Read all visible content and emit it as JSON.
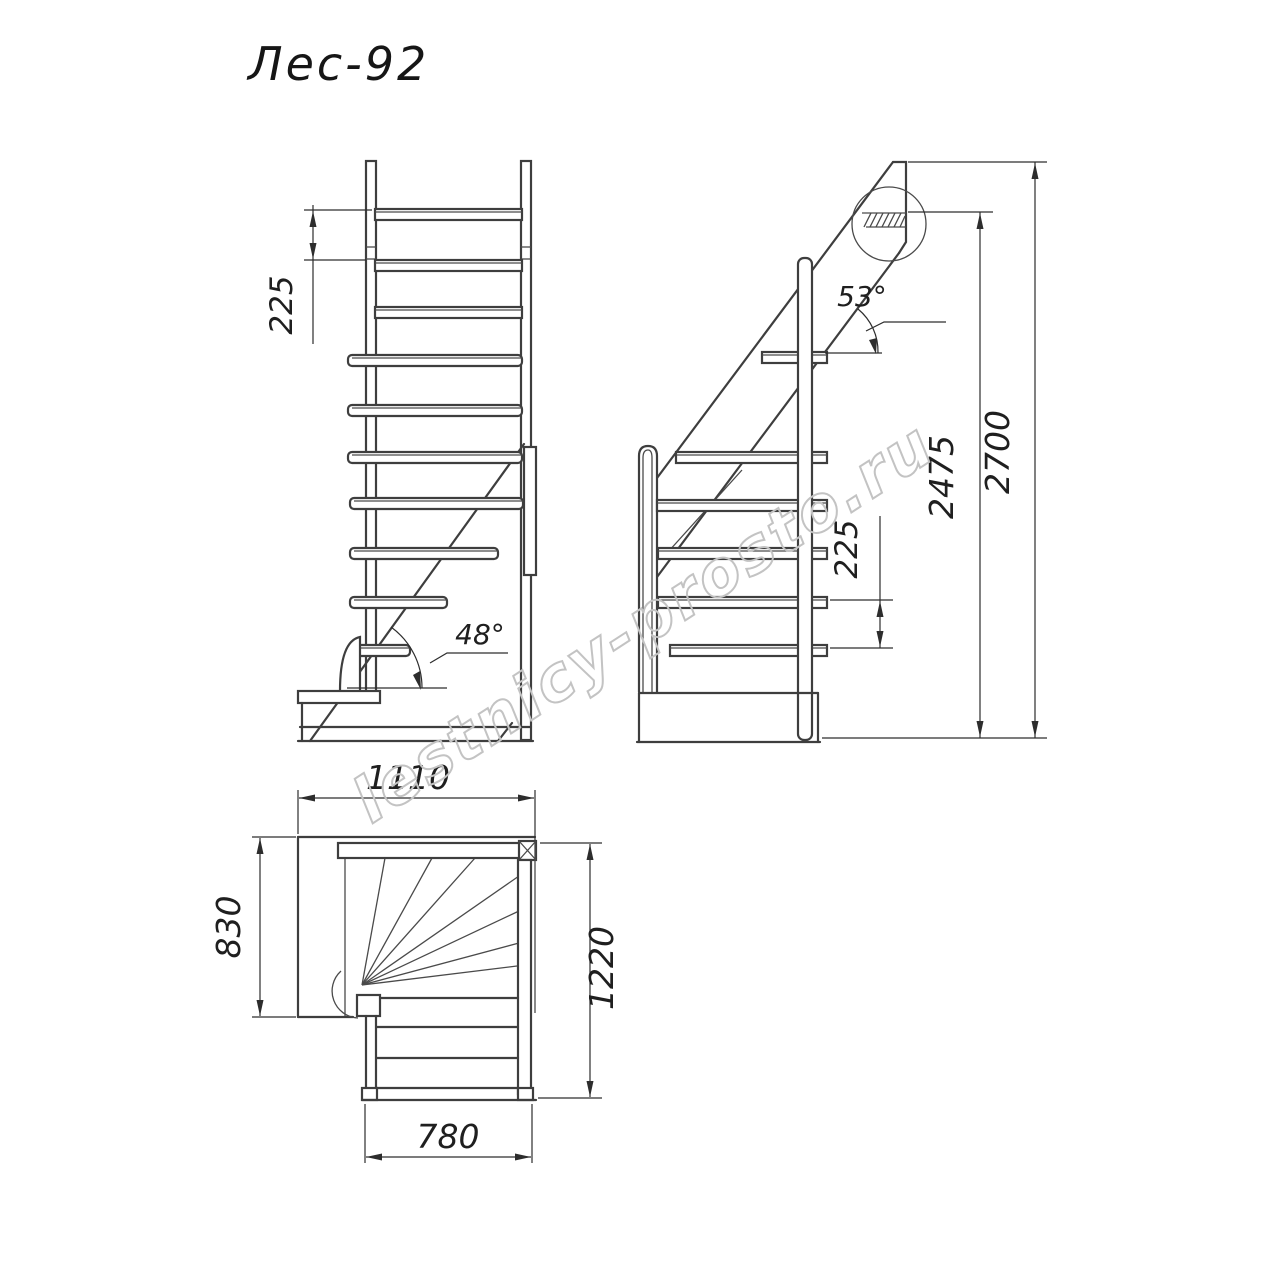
{
  "title": "Лес-92",
  "watermark": "lestnicy-prosto.ru",
  "colors": {
    "line": "#3e3e3e",
    "dim_text": "#1f1f1f",
    "watermark": "#c3c3c3",
    "background": "#ffffff"
  },
  "front_view": {
    "riser_spacing_mm": "225",
    "lower_flight_angle": "48°"
  },
  "side_view": {
    "upper_flight_angle": "53°",
    "riser_spacing_mm": "225",
    "floor_to_rail_height_mm": "2475",
    "total_height_mm": "2700"
  },
  "plan_view": {
    "overall_width_mm": "1110",
    "winder_depth_mm": "830",
    "overall_depth_mm": "1220",
    "flight_width_mm": "780"
  }
}
